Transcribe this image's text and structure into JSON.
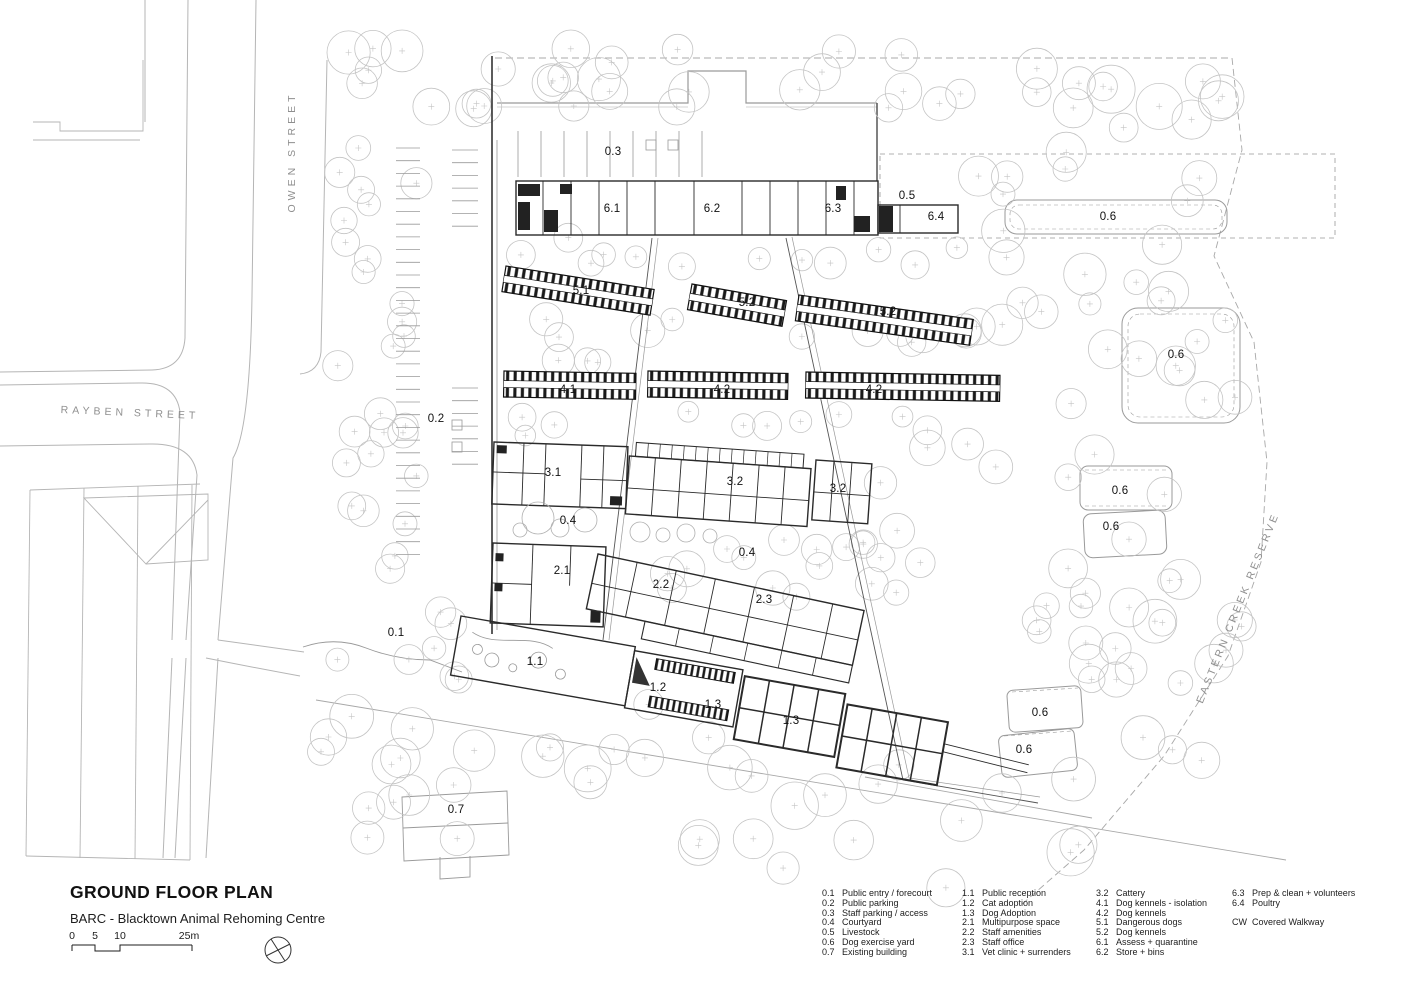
{
  "title_block": {
    "title": "GROUND FLOOR PLAN",
    "subtitle": "BARC - Blacktown Animal Rehoming Centre",
    "scale_ticks": [
      "0",
      "5",
      "10",
      "25m"
    ]
  },
  "streets": {
    "owen": "OWEN STREET",
    "rayben": "RAYBEN STREET",
    "reserve": "EASTERN CREEK RESERVE"
  },
  "colors": {
    "paper": "#ffffff",
    "ink": "#1a1a1a",
    "light_line": "#b5b5b5",
    "tree_line": "#c4c4c4"
  },
  "plan_labels": [
    {
      "text": "0.3",
      "x": 613,
      "y": 152
    },
    {
      "text": "6.1",
      "x": 612,
      "y": 209
    },
    {
      "text": "6.2",
      "x": 712,
      "y": 209
    },
    {
      "text": "6.3",
      "x": 833,
      "y": 209
    },
    {
      "text": "0.5",
      "x": 907,
      "y": 196
    },
    {
      "text": "6.4",
      "x": 936,
      "y": 217
    },
    {
      "text": "0.6",
      "x": 1108,
      "y": 217
    },
    {
      "text": "5.1",
      "x": 581,
      "y": 291
    },
    {
      "text": "5.2",
      "x": 747,
      "y": 303
    },
    {
      "text": "5.2",
      "x": 888,
      "y": 312
    },
    {
      "text": "0.6",
      "x": 1176,
      "y": 355
    },
    {
      "text": "4.1",
      "x": 568,
      "y": 390
    },
    {
      "text": "4.2",
      "x": 722,
      "y": 390
    },
    {
      "text": "4.2",
      "x": 874,
      "y": 390
    },
    {
      "text": "0.2",
      "x": 436,
      "y": 419
    },
    {
      "text": "3.1",
      "x": 553,
      "y": 473
    },
    {
      "text": "3.2",
      "x": 735,
      "y": 482
    },
    {
      "text": "3.2",
      "x": 838,
      "y": 489
    },
    {
      "text": "0.6",
      "x": 1120,
      "y": 491
    },
    {
      "text": "0.4",
      "x": 568,
      "y": 521
    },
    {
      "text": "0.6",
      "x": 1111,
      "y": 527
    },
    {
      "text": "0.4",
      "x": 747,
      "y": 553
    },
    {
      "text": "2.1",
      "x": 562,
      "y": 571
    },
    {
      "text": "2.2",
      "x": 661,
      "y": 585
    },
    {
      "text": "2.3",
      "x": 764,
      "y": 600
    },
    {
      "text": "0.1",
      "x": 396,
      "y": 633
    },
    {
      "text": "1.1",
      "x": 535,
      "y": 662
    },
    {
      "text": "1.2",
      "x": 658,
      "y": 688
    },
    {
      "text": "1.3",
      "x": 713,
      "y": 705
    },
    {
      "text": "1.3",
      "x": 791,
      "y": 721
    },
    {
      "text": "0.6",
      "x": 1040,
      "y": 713
    },
    {
      "text": "0.6",
      "x": 1024,
      "y": 750
    },
    {
      "text": "0.7",
      "x": 456,
      "y": 810
    }
  ],
  "legend": {
    "columns": [
      [
        {
          "num": "0.1",
          "label": "Public entry / forecourt"
        },
        {
          "num": "0.2",
          "label": "Public parking"
        },
        {
          "num": "0.3",
          "label": "Staff parking / access"
        },
        {
          "num": "0.4",
          "label": "Courtyard"
        },
        {
          "num": "0.5",
          "label": "Livestock"
        },
        {
          "num": "0.6",
          "label": "Dog exercise yard"
        },
        {
          "num": "0.7",
          "label": "Existing building"
        }
      ],
      [
        {
          "num": "1.1",
          "label": "Public reception"
        },
        {
          "num": "1.2",
          "label": "Cat adoption"
        },
        {
          "num": "1.3",
          "label": "Dog Adoption"
        },
        {
          "num": "2.1",
          "label": "Multipurpose space"
        },
        {
          "num": "2.2",
          "label": "Staff amenities"
        },
        {
          "num": "2.3",
          "label": "Staff office"
        },
        {
          "num": "3.1",
          "label": "Vet clinic + surrenders"
        }
      ],
      [
        {
          "num": "3.2",
          "label": "Cattery"
        },
        {
          "num": "4.1",
          "label": "Dog kennels - isolation"
        },
        {
          "num": "4.2",
          "label": "Dog kennels"
        },
        {
          "num": "5.1",
          "label": "Dangerous dogs"
        },
        {
          "num": "5.2",
          "label": "Dog kennels"
        },
        {
          "num": "6.1",
          "label": "Assess + quarantine"
        },
        {
          "num": "6.2",
          "label": "Store + bins"
        }
      ],
      [
        {
          "num": "6.3",
          "label": "Prep & clean + volunteers"
        },
        {
          "num": "6.4",
          "label": "Poultry"
        },
        {
          "num": "",
          "label": ""
        },
        {
          "num": "CW",
          "label": "Covered Walkway"
        }
      ]
    ]
  }
}
